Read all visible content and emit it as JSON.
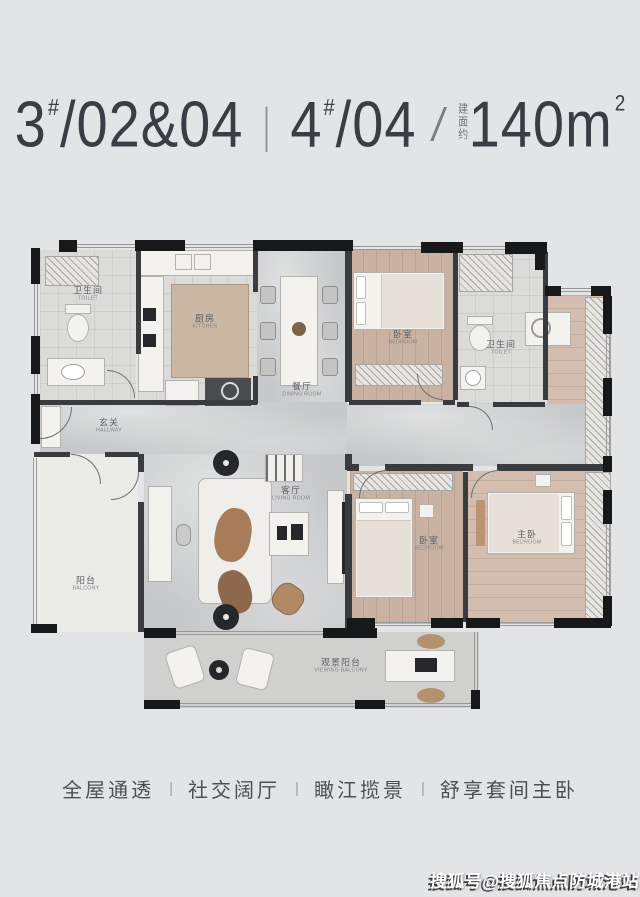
{
  "title": {
    "unit1": "3",
    "unit1_sup": "#",
    "unit1_rest": "/02&04",
    "divider": "|",
    "unit2": "4",
    "unit2_sup": "#",
    "unit2_rest": "/04",
    "slash": "/",
    "area_label": "建面约",
    "area_value": "140m",
    "area_sup": "2"
  },
  "floorplan": {
    "rooms": [
      {
        "id": "bath-main",
        "zh": "卫生间",
        "en": "TOILET"
      },
      {
        "id": "kitchen",
        "zh": "厨房",
        "en": "KITCHEN"
      },
      {
        "id": "dining",
        "zh": "餐厅",
        "en": "DINING ROOM"
      },
      {
        "id": "bedroom-top",
        "zh": "卧室",
        "en": "BEDROOM"
      },
      {
        "id": "bath-right",
        "zh": "卫生间",
        "en": "TOILET"
      },
      {
        "id": "hallway",
        "zh": "玄关",
        "en": "HALLWAY"
      },
      {
        "id": "living",
        "zh": "客厅",
        "en": "LIVING ROOM"
      },
      {
        "id": "balcony-left",
        "zh": "阳台",
        "en": "BALCONY"
      },
      {
        "id": "bedroom-mid",
        "zh": "卧室",
        "en": "BEDROOM"
      },
      {
        "id": "master-bedroom",
        "zh": "主卧",
        "en": "BEDROOM"
      },
      {
        "id": "viewing-balcony",
        "zh": "观景阳台",
        "en": "VIEWING BALCONY"
      }
    ]
  },
  "features": {
    "items": [
      "全屋通透",
      "社交阔厅",
      "瞰江揽景",
      "舒享套间主卧"
    ],
    "divider": "|"
  },
  "watermark": "搜狐号@搜狐焦点防城港站",
  "colors": {
    "background": "#e3e4e6",
    "title_text": "#3a3e44",
    "wall": "#17181a",
    "wood_floor": "#c9b2a1",
    "marble_floor": "#c6c8c9",
    "feature_text": "#4c5056",
    "watermark_fill": "#ffffff",
    "watermark_shadow": "#3e3e40"
  }
}
